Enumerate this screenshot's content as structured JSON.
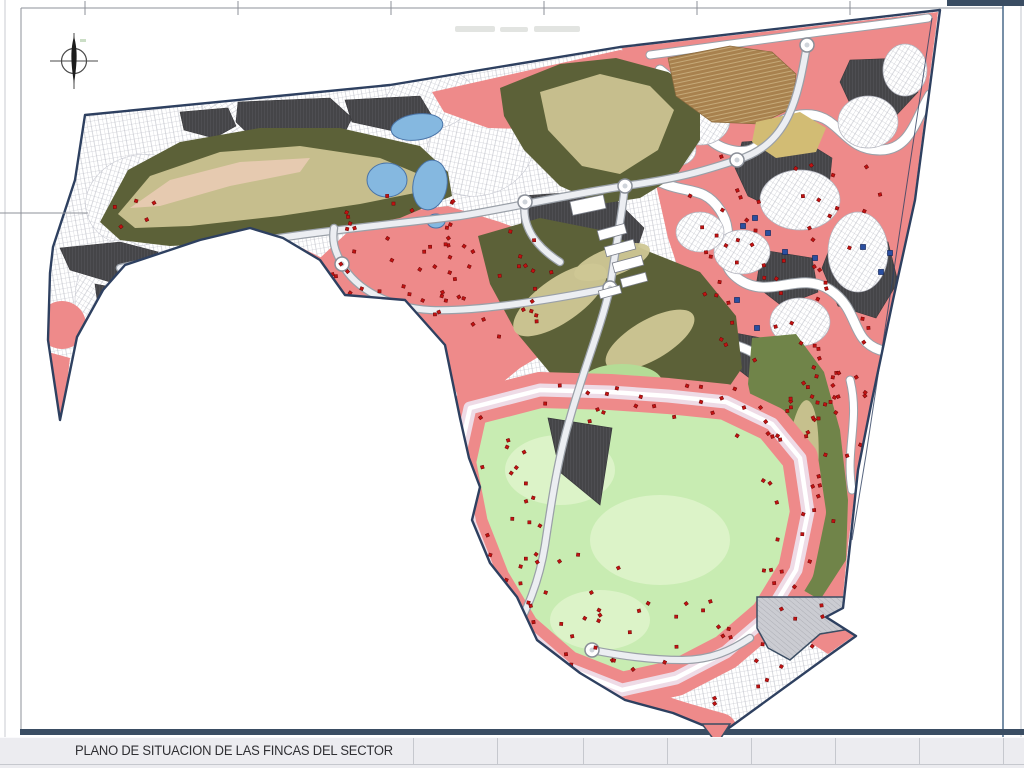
{
  "page": {
    "title_block": {
      "title": "PLANO DE SITUACION DE LAS FINCAS DEL SECTOR",
      "separators_x": [
        413,
        497,
        583,
        667,
        751,
        835,
        919,
        1003
      ]
    },
    "frame": {
      "left_line_x": 5,
      "inner_left_x": 21,
      "top_line_y": 8,
      "top_ticks_x": [
        85,
        238,
        391,
        544,
        697,
        850,
        1003
      ],
      "left_tick_y": 213,
      "right_line_x": 1003,
      "right_edge_x": 1021,
      "bottom_bar": {
        "x": 20,
        "y": 729,
        "w": 1004,
        "h": 6
      },
      "topright_bar": {
        "x": 947,
        "y": 0,
        "w": 77,
        "h": 6
      }
    },
    "compass": {
      "cx": 74,
      "cy": 61,
      "r": 12.5
    },
    "faint_note_rects": [
      [
        455,
        26,
        40,
        6
      ],
      [
        500,
        27,
        28,
        5
      ],
      [
        534,
        26,
        46,
        6
      ]
    ]
  },
  "map": {
    "colors": {
      "white": "#ffffff",
      "plotLine": "#b4b6c0",
      "pink": "#ee8a8a",
      "red": "#c21212",
      "redEdge": "#6d0707",
      "charcoal": "#454548",
      "charLine": "#63636a",
      "olive": "#5c6138",
      "olive2": "#708449",
      "khaki": "#cfc795",
      "tanLight": "#e6cab0",
      "lightGreen": "#c8ecb2",
      "lightGreen2": "#dcf3c8",
      "greenPatch": "#b4dc96",
      "lake": "#85b8e0",
      "lakeEdge": "#4a74a8",
      "tanBrown": "#a8814e",
      "terrace": "#cdb383",
      "tanYellow": "#d2bc74",
      "roadFill": "#eceef2",
      "roadCase": "#9aa0a8",
      "street": "#eedbe6",
      "grayPark": "#cbccd2",
      "parkLine": "#9b9ca4",
      "boundary": "#2e4060",
      "navy": "#3a4d63",
      "blueSq": "#2a4fa0",
      "blueSqEdge": "#142a60",
      "islandEdge": "#b0b2bc",
      "frameMid": "#8e9198",
      "frameLight": "#c9cbd1",
      "frameRight": "#4a6a8a",
      "faint": "#d6d8d4"
    },
    "boundary": [
      85,
      115,
      390,
      85,
      620,
      47,
      940,
      10,
      915,
      200,
      893,
      300,
      872,
      400,
      858,
      470,
      850,
      545,
      843,
      608,
      826,
      617,
      856,
      636,
      828,
      656,
      722,
      733,
      673,
      713,
      625,
      700,
      580,
      673,
      537,
      640,
      517,
      597,
      490,
      563,
      472,
      520,
      480,
      487,
      469,
      458,
      460,
      418,
      445,
      345,
      405,
      300,
      345,
      295,
      320,
      260,
      283,
      238,
      250,
      228,
      200,
      240,
      125,
      265,
      103,
      290,
      77,
      337,
      60,
      420,
      48,
      340,
      50,
      273,
      53,
      247,
      75,
      180
    ],
    "right_edge_inner": "M932,18 L866,455 L852,540",
    "texture_blobs": [
      [
        140,
        200,
        55,
        45,
        -15
      ],
      [
        300,
        170,
        70,
        50,
        10
      ],
      [
        250,
        120,
        50,
        35,
        25
      ],
      [
        480,
        150,
        55,
        45,
        -20
      ],
      [
        560,
        120,
        50,
        40,
        15
      ],
      [
        120,
        300,
        45,
        60,
        0
      ],
      [
        180,
        330,
        50,
        40,
        30
      ],
      [
        430,
        100,
        45,
        30,
        -10
      ]
    ],
    "pink_polys": [
      [
        622,
        48,
        938,
        12,
        914,
        200,
        893,
        300,
        872,
        400,
        858,
        468,
        848,
        545,
        842,
        606,
        827,
        616,
        855,
        635,
        828,
        654,
        788,
        628,
        798,
        560,
        788,
        498,
        760,
        468,
        740,
        430,
        712,
        398,
        700,
        358,
        688,
        298,
        668,
        238,
        650,
        158,
        634,
        98
      ],
      [
        320,
        258,
        352,
        228,
        400,
        212,
        448,
        206,
        500,
        222,
        548,
        240,
        588,
        262,
        612,
        286,
        596,
        318,
        560,
        344,
        520,
        368,
        486,
        396,
        466,
        420,
        452,
        380,
        440,
        344,
        410,
        306,
        350,
        298
      ],
      [
        432,
        92,
        530,
        70,
        620,
        50,
        668,
        56,
        676,
        96,
        640,
        110,
        560,
        130,
        488,
        128,
        444,
        112
      ],
      [
        48,
        352,
        70,
        358,
        62,
        425,
        50,
        418
      ],
      [
        286,
        240,
        330,
        262,
        348,
        294,
        330,
        300,
        300,
        278,
        278,
        252
      ]
    ],
    "pink_ellipses": [
      [
        62,
        325,
        24,
        24
      ],
      [
        118,
        206,
        8,
        7
      ],
      [
        98,
        252,
        6,
        5
      ],
      [
        150,
        315,
        7,
        6
      ]
    ],
    "pink_strokes": [
      {
        "d": "M460,420 C466,470 470,520 490,560 C510,600 540,640 580,672 C620,702 670,716 720,730",
        "w": 34
      }
    ],
    "charcoal_polys": [
      [
        238,
        102,
        330,
        98,
        352,
        118,
        340,
        142,
        300,
        152,
        258,
        143,
        236,
        122
      ],
      [
        180,
        112,
        228,
        108,
        236,
        126,
        214,
        138,
        184,
        130
      ],
      [
        80,
        352,
        150,
        344,
        210,
        352,
        250,
        362,
        248,
        382,
        212,
        392,
        178,
        380,
        140,
        392,
        120,
        410,
        92,
        406,
        78,
        386
      ],
      [
        60,
        248,
        120,
        242,
        158,
        252,
        150,
        272,
        110,
        282,
        70,
        270
      ],
      [
        95,
        284,
        140,
        292,
        130,
        312,
        98,
        306
      ],
      [
        520,
        196,
        606,
        190,
        644,
        228,
        634,
        258,
        560,
        262,
        522,
        230
      ],
      [
        742,
        142,
        800,
        138,
        832,
        158,
        828,
        196,
        788,
        215,
        748,
        196,
        735,
        168
      ],
      [
        836,
        232,
        888,
        242,
        898,
        282,
        876,
        318,
        838,
        306,
        822,
        268
      ],
      [
        762,
        250,
        812,
        258,
        818,
        292,
        782,
        306,
        756,
        286
      ],
      [
        850,
        60,
        905,
        58,
        918,
        92,
        890,
        122,
        852,
        108,
        840,
        82
      ],
      [
        730,
        332,
        772,
        340,
        780,
        368,
        752,
        380,
        726,
        360
      ],
      [
        760,
        490,
        806,
        498,
        820,
        540,
        796,
        572,
        760,
        556,
        748,
        520
      ],
      [
        345,
        100,
        420,
        96,
        432,
        116,
        398,
        132,
        352,
        122
      ]
    ],
    "serpentines": [
      {
        "d": "M650,55 C700,48 760,40 820,32 C870,26 900,22 928,18",
        "w": 7
      },
      {
        "d": "M660,70 C700,100 690,140 730,150 C770,160 760,120 800,115 C840,110 840,150 880,150 C910,150 915,120 930,95",
        "w": 9
      },
      {
        "d": "M640,170 C680,200 700,180 720,210 C740,240 710,260 740,280 C770,300 800,270 830,290 C860,310 850,340 880,350",
        "w": 9
      },
      {
        "d": "M700,330 C730,350 750,340 770,370 C790,400 780,420 810,440",
        "w": 8
      },
      {
        "d": "M850,380 C860,420 845,450 852,490",
        "w": 7
      }
    ],
    "islands": [
      [
        700,
        120,
        30,
        25
      ],
      [
        762,
        92,
        34,
        20
      ],
      [
        868,
        122,
        30,
        26
      ],
      [
        800,
        200,
        40,
        30
      ],
      [
        742,
        252,
        28,
        22
      ],
      [
        858,
        252,
        30,
        40
      ],
      [
        800,
        322,
        30,
        24
      ],
      [
        700,
        232,
        24,
        20
      ],
      [
        676,
        150,
        20,
        16
      ],
      [
        905,
        70,
        22,
        26
      ]
    ],
    "greens": {
      "g1": [
        100,
        222,
        128,
        170,
        180,
        142,
        260,
        128,
        340,
        128,
        420,
        146,
        448,
        172,
        452,
        196,
        400,
        218,
        330,
        232,
        250,
        242,
        170,
        246,
        120,
        240
      ],
      "k1": [
        118,
        214,
        150,
        176,
        220,
        152,
        300,
        146,
        380,
        158,
        428,
        178,
        430,
        190,
        360,
        204,
        280,
        216,
        190,
        226,
        135,
        228
      ],
      "t1": [
        130,
        208,
        170,
        180,
        240,
        162,
        310,
        158,
        300,
        172,
        230,
        186,
        160,
        206
      ],
      "g2": [
        500,
        88,
        560,
        64,
        616,
        58,
        668,
        72,
        700,
        92,
        700,
        140,
        676,
        176,
        640,
        198,
        600,
        204,
        560,
        186,
        524,
        150,
        504,
        116
      ],
      "k2": [
        540,
        92,
        600,
        74,
        650,
        86,
        674,
        110,
        658,
        150,
        620,
        174,
        582,
        166,
        548,
        130
      ],
      "g3": [
        478,
        236,
        540,
        218,
        600,
        230,
        650,
        252,
        700,
        272,
        736,
        316,
        742,
        368,
        716,
        406,
        664,
        420,
        608,
        408,
        556,
        380,
        516,
        332,
        490,
        284
      ],
      "k3_ellipses": [
        [
          560,
          300,
          55,
          22,
          -35
        ],
        [
          650,
          340,
          50,
          20,
          -30
        ],
        [
          612,
          262,
          40,
          14,
          -20
        ]
      ],
      "g4": [
        752,
        338,
        796,
        334,
        824,
        372,
        840,
        430,
        848,
        500,
        846,
        560,
        820,
        600,
        796,
        586,
        776,
        520,
        760,
        440,
        748,
        384
      ],
      "k4_ellipse": [
        802,
        470,
        16,
        70,
        4
      ],
      "green_patch": [
        622,
        382,
        40,
        18
      ]
    },
    "meadow": [
      470,
      408,
      540,
      390,
      610,
      392,
      668,
      396,
      726,
      402,
      772,
      424,
      800,
      458,
      808,
      512,
      796,
      570,
      768,
      616,
      726,
      652,
      676,
      678,
      622,
      690,
      566,
      668,
      522,
      630,
      492,
      580,
      470,
      524,
      458,
      462
    ],
    "meadow_blotches": [
      [
        560,
        470,
        55,
        35
      ],
      [
        660,
        540,
        70,
        45
      ],
      [
        600,
        620,
        50,
        30
      ]
    ],
    "lakes": [
      [
        417,
        127,
        26,
        13,
        -8
      ],
      [
        387,
        180,
        20,
        17,
        0
      ],
      [
        430,
        185,
        17,
        25,
        10
      ],
      [
        436,
        221,
        9,
        7,
        0
      ]
    ],
    "tan_polys": [
      [
        668,
        58,
        730,
        46,
        772,
        52,
        796,
        74,
        792,
        108,
        760,
        124,
        712,
        122,
        676,
        96
      ]
    ],
    "tan_yellow_poly": [
      756,
      122,
      800,
      112,
      826,
      128,
      816,
      152,
      776,
      158,
      752,
      142
    ],
    "dark_triangle": [
      548,
      418,
      612,
      428,
      600,
      505,
      560,
      472
    ],
    "parking": [
      757,
      597,
      856,
      597,
      856,
      628,
      820,
      634,
      790,
      660,
      768,
      648,
      757,
      628
    ],
    "roads": [
      "M204,252 C280,234 380,226 460,216 C500,210 560,196 625,186 C680,178 700,172 737,160 C790,144 798,96 807,45",
      "M525,202 C521,228 538,248 560,262",
      "M625,186 C621,220 615,252 610,288",
      "M610,288 C540,302 470,312 430,310 C392,308 356,290 342,264 C334,250 332,240 334,228",
      "M610,288 C600,330 584,368 570,418 C558,458 552,498 545,545 C538,590 522,618 506,652 C497,672 492,688 494,708",
      "M204,252 C176,258 146,262 120,268",
      "M592,650 C622,656 652,660 682,660 C712,660 732,650 750,638"
    ],
    "roundabouts": [
      [
        342,
        264
      ],
      [
        525,
        202
      ],
      [
        625,
        186
      ],
      [
        737,
        160
      ],
      [
        610,
        288
      ],
      [
        807,
        45
      ],
      [
        592,
        650
      ]
    ],
    "buildings": [
      [
        612,
        232,
        28,
        10,
        -15
      ],
      [
        620,
        248,
        30,
        10,
        -15
      ],
      [
        628,
        264,
        30,
        10,
        -15
      ],
      [
        634,
        280,
        26,
        9,
        -15
      ],
      [
        610,
        292,
        22,
        8,
        -15
      ],
      [
        245,
        280,
        26,
        9,
        18
      ],
      [
        262,
        292,
        26,
        9,
        12
      ],
      [
        281,
        303,
        24,
        8,
        8
      ],
      [
        300,
        312,
        22,
        8,
        4
      ],
      [
        588,
        205,
        34,
        14,
        -12
      ]
    ],
    "dot_clusters": [
      [
        335,
        195,
        120,
        115,
        26
      ],
      [
        425,
        225,
        130,
        115,
        30
      ],
      [
        690,
        150,
        200,
        140,
        38
      ],
      [
        700,
        292,
        170,
        128,
        30
      ],
      [
        795,
        355,
        85,
        115,
        22
      ],
      [
        755,
        470,
        80,
        150,
        22
      ],
      [
        545,
        385,
        280,
        55,
        26
      ],
      [
        455,
        398,
        85,
        225,
        24
      ],
      [
        490,
        545,
        130,
        130,
        20
      ],
      [
        560,
        600,
        300,
        105,
        30
      ],
      [
        300,
        250,
        95,
        75,
        14
      ],
      [
        108,
        194,
        52,
        38,
        5
      ]
    ],
    "blue_squares": [
      [
        755,
        218
      ],
      [
        743,
        226
      ],
      [
        768,
        233
      ],
      [
        785,
        252
      ],
      [
        815,
        258
      ],
      [
        863,
        247
      ],
      [
        890,
        253
      ],
      [
        881,
        272
      ],
      [
        737,
        300
      ],
      [
        757,
        328
      ]
    ],
    "tip_triangle": [
      702,
      724,
      730,
      724,
      717,
      744
    ]
  }
}
